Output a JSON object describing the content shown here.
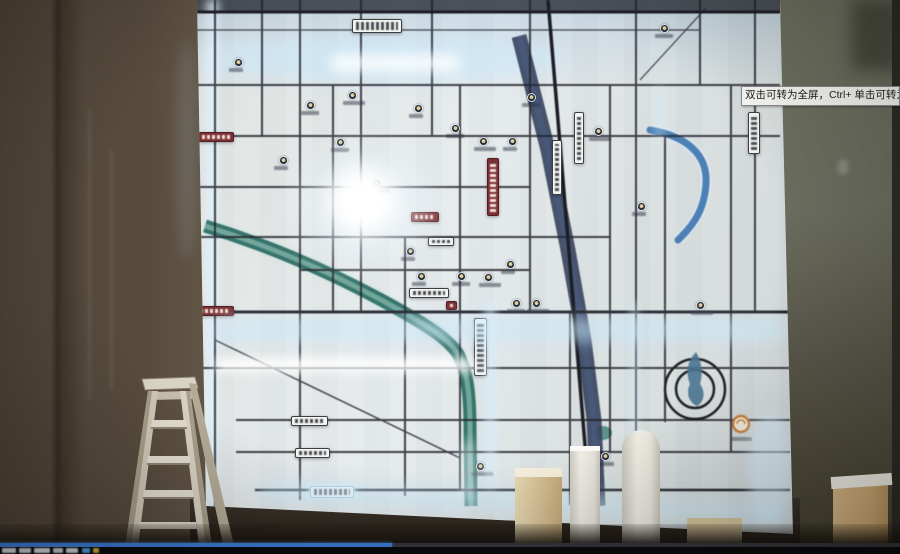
{
  "player": {
    "tooltip_text": "双击可转为全屏，Ctrl+ 单击可转为",
    "seekbar": {
      "progress_fraction": 0.435,
      "progress_color": "#3b7cd4",
      "track_color": "#33363b"
    }
  },
  "scene": {
    "colors": {
      "wall_left": "#54483b",
      "wall_right": "#6b6d5f",
      "map_base": "#dfe4e4",
      "led_glow": "#dff2ff",
      "road": "#23242c",
      "river_teal": "#2f6e66",
      "river_blue": "#36435e",
      "canal_blue": "#4d80b4",
      "red_label": "#7d3034",
      "orange_logo": "#c8803e",
      "ladder": "#cfc7b6",
      "pillar_white": "#efede5",
      "pillar_tan": "#d3bd90"
    }
  },
  "map": {
    "pois": [
      {
        "x": 238,
        "y": 62
      },
      {
        "x": 310,
        "y": 105
      },
      {
        "x": 352,
        "y": 95
      },
      {
        "x": 283,
        "y": 160
      },
      {
        "x": 340,
        "y": 142
      },
      {
        "x": 376,
        "y": 183
      },
      {
        "x": 418,
        "y": 108
      },
      {
        "x": 455,
        "y": 128
      },
      {
        "x": 483,
        "y": 141
      },
      {
        "x": 512,
        "y": 141
      },
      {
        "x": 531,
        "y": 97
      },
      {
        "x": 598,
        "y": 131
      },
      {
        "x": 421,
        "y": 276
      },
      {
        "x": 461,
        "y": 276
      },
      {
        "x": 488,
        "y": 277
      },
      {
        "x": 510,
        "y": 264
      },
      {
        "x": 516,
        "y": 303
      },
      {
        "x": 536,
        "y": 303
      },
      {
        "x": 410,
        "y": 251
      },
      {
        "x": 605,
        "y": 456
      },
      {
        "x": 480,
        "y": 466
      },
      {
        "x": 641,
        "y": 206
      },
      {
        "x": 664,
        "y": 28
      },
      {
        "x": 700,
        "y": 305
      }
    ],
    "signs": [
      {
        "x": 352,
        "y": 19,
        "w": 50,
        "h": 14,
        "kind": "white-h"
      },
      {
        "x": 748,
        "y": 112,
        "w": 12,
        "h": 42,
        "kind": "white-v"
      },
      {
        "x": 552,
        "y": 140,
        "w": 10,
        "h": 55,
        "kind": "white-v"
      },
      {
        "x": 574,
        "y": 112,
        "w": 10,
        "h": 52,
        "kind": "white-v"
      },
      {
        "x": 474,
        "y": 318,
        "w": 13,
        "h": 58,
        "kind": "white-v"
      },
      {
        "x": 409,
        "y": 288,
        "w": 40,
        "h": 10,
        "kind": "white-h"
      },
      {
        "x": 428,
        "y": 237,
        "w": 26,
        "h": 9,
        "kind": "white-h"
      },
      {
        "x": 291,
        "y": 416,
        "w": 37,
        "h": 10,
        "kind": "white-h"
      },
      {
        "x": 295,
        "y": 448,
        "w": 35,
        "h": 10,
        "kind": "white-h"
      },
      {
        "x": 310,
        "y": 486,
        "w": 44,
        "h": 12,
        "kind": "glow-h"
      },
      {
        "x": 198,
        "y": 132,
        "w": 36,
        "h": 10,
        "kind": "red-h"
      },
      {
        "x": 186,
        "y": 306,
        "w": 48,
        "h": 10,
        "kind": "red-h"
      },
      {
        "x": 487,
        "y": 158,
        "w": 12,
        "h": 58,
        "kind": "red-v"
      },
      {
        "x": 411,
        "y": 212,
        "w": 28,
        "h": 10,
        "kind": "red-h"
      },
      {
        "x": 446,
        "y": 301,
        "w": 11,
        "h": 9,
        "kind": "red-h"
      }
    ]
  }
}
